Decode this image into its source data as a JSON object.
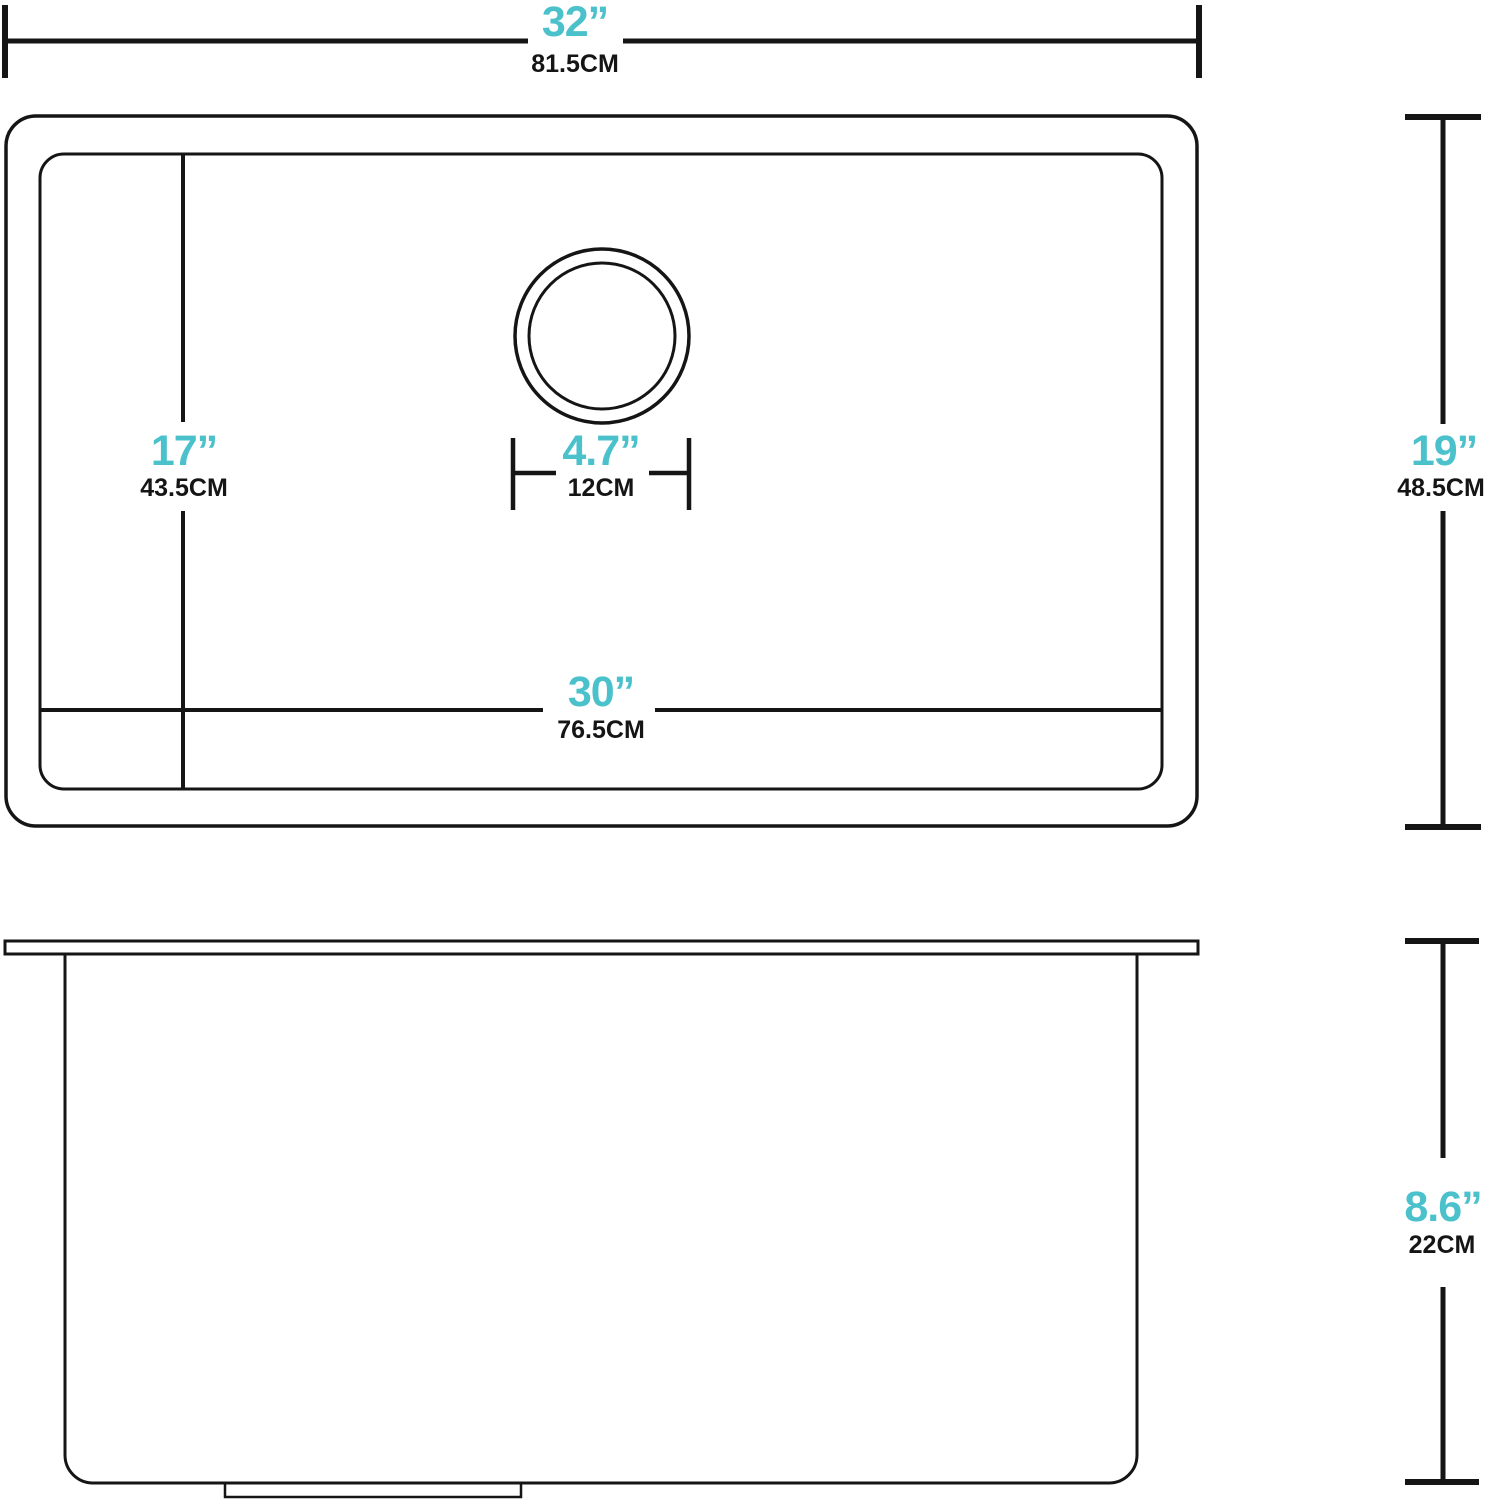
{
  "colors": {
    "accent": "#4bc1cc",
    "line": "#151515",
    "background": "#ffffff"
  },
  "dimensions": {
    "overall_width": {
      "in": "32”",
      "cm": "81.5CM"
    },
    "overall_depth": {
      "in": "19”",
      "cm": "48.5CM"
    },
    "bowl_width": {
      "in": "30”",
      "cm": "76.5CM"
    },
    "bowl_depth": {
      "in": "17”",
      "cm": "43.5CM"
    },
    "drain_diameter": {
      "in": "4.7”",
      "cm": "12CM"
    },
    "bowl_height": {
      "in": "8.6”",
      "cm": "22CM"
    }
  }
}
